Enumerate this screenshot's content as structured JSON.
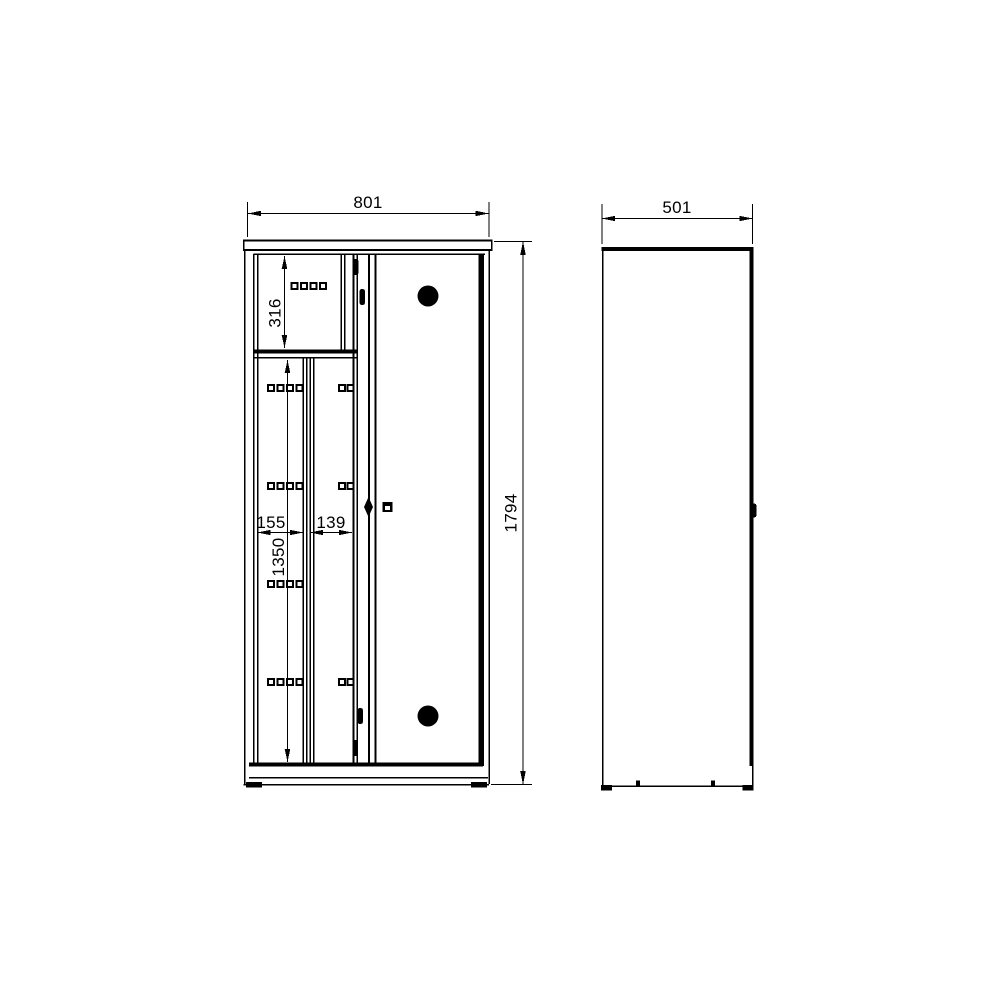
{
  "drawing": {
    "type": "technical-drawing",
    "subject": "wardrobe-cabinet-two-view-dimension-drawing",
    "background": "#ffffff",
    "line_color": "#000000",
    "front_view": {
      "name": "front view",
      "dim_width": "801",
      "dim_height": "1794",
      "dim_top_compartment_height": "316",
      "dim_left_bay_width": "155",
      "dim_middle_bay_width": "139",
      "dim_lower_section_height": "1350"
    },
    "side_view": {
      "name": "side view",
      "dim_depth": "501"
    }
  }
}
